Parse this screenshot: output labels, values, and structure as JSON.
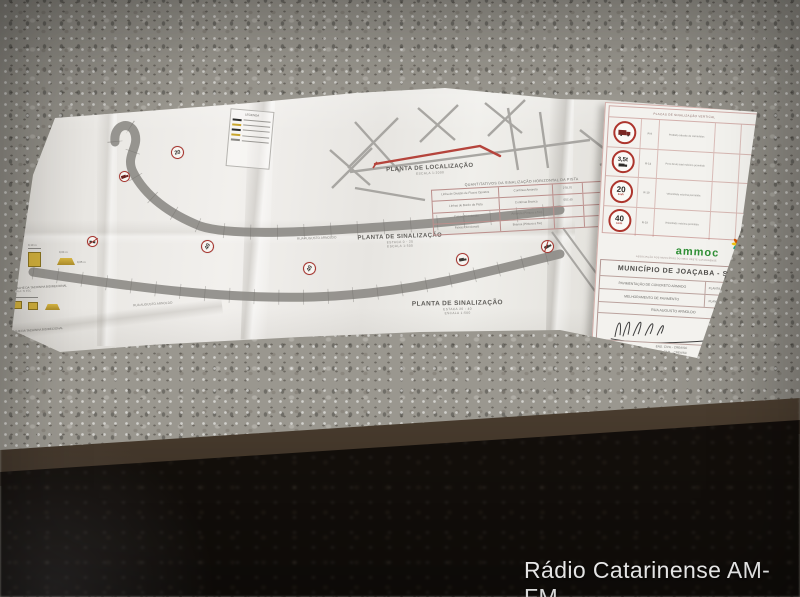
{
  "watermark": {
    "text": "Rádio Catarinense AM-FM"
  },
  "paper": {
    "location_plan": {
      "title": "PLANTA DE LOCALIZAÇÃO",
      "scale": "ESCALA 1:2000"
    },
    "signal_plan_a": {
      "title": "PLANTA DE SINALIZAÇÃO",
      "stake": "ESTACA 0 - 20",
      "scale": "ESCALA 1:500"
    },
    "signal_plan_b": {
      "title": "PLANTA DE SINALIZAÇÃO",
      "stake": "ESTACA 20 - 40",
      "scale": "ESCALA 1:500"
    },
    "streets": {
      "upper": "RUA AUGUSTO ARNOLDO",
      "lower": "RUA AUGUSTO ARNOLDO"
    },
    "details": {
      "detail_a_title": "DETALHE DA TACHINHA BIDIRECIONAL",
      "detail_a_scale": "ESCALA: S/ ESC",
      "detail_b_title": "DETALHE DA TACHINHA BIDIRECIONAL",
      "dim_1": "0,10 m",
      "dim_2": "0,05 m",
      "dim_3": "0,04 m"
    },
    "legend": {
      "title": "LEGENDA"
    },
    "qty_table": {
      "title": "QUANTITATIVOS DA SINALIZAÇÃO HORIZONTAL DA PISTA",
      "rows": [
        {
          "c1": "Linha de Divisão de Fluxos Opostos",
          "c2": "Contínua Amarela",
          "c3": "278,70"
        },
        {
          "c1": "Linhas de Bordo da Pista",
          "c2": "Contínua Branca",
          "c3": "557,40"
        },
        {
          "c1": "Faixas Direcionais",
          "c2": "Amarela (Pintura a frio)",
          "c3": ""
        },
        {
          "c1": "Faixas Direcionais",
          "c2": "Branca (Pintura a frio)",
          "c3": ""
        }
      ]
    },
    "road_signs": {
      "speed20": "20",
      "speed40": "40",
      "kmh": "km/h"
    }
  },
  "panel": {
    "sign_table_title": "PLACAS DE SINALIZAÇÃO VERTICAL",
    "rows": [
      {
        "code": "R-9",
        "desc": "Proibido trânsito de caminhões"
      },
      {
        "code": "R-14",
        "desc": "Peso bruto total máximo permitido",
        "value": "3,5t"
      },
      {
        "code": "R-19",
        "desc": "Velocidade máxima permitida",
        "value": "20",
        "unit": "km/h"
      },
      {
        "code": "R-19",
        "desc": "Velocidade máxima permitida",
        "value": "40",
        "unit": "km/h"
      }
    ],
    "logo": {
      "name": "ammoc",
      "caption": "ASSOCIAÇÃO DOS MUNICÍPIOS DO MEIO OESTE CATARINENSE"
    },
    "title_block": {
      "municipality": "MUNICÍPIO DE JOAÇABA - SC",
      "project_1": "PAVIMENTAÇÃO DE CONCRETO ARMADO",
      "project_2": "MELHORAMENTO DE PAVIMENTO",
      "street": "RUA AUGUSTO ARNOLDO",
      "sheet_1": "PLANTA DE LOCALIZAÇÃO",
      "sheet_2": "PLANTA DE SINALIZAÇÃO",
      "eng_1": "ENG. CIVIL - CREA/SC",
      "eng_2": "ENG. CIVIL - CREA/SC",
      "eng_3": "ENG. CIVIL - CREA/SC",
      "foot_1": "DATA",
      "foot_2": "ESCALA",
      "foot_3": "DESENHO",
      "foot_4": "FOLHA"
    }
  }
}
